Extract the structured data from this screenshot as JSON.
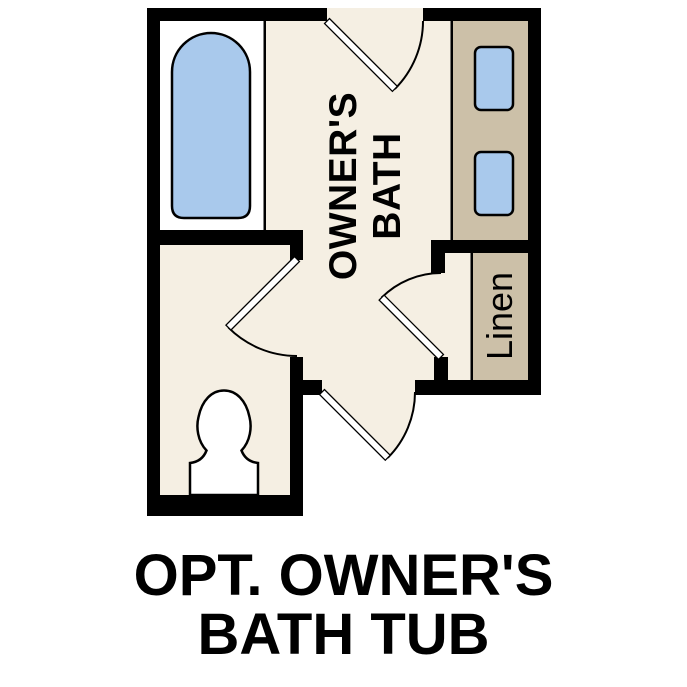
{
  "plan": {
    "room_label": {
      "line1": "OWNER'S",
      "line2": "BATH"
    },
    "closet_label": "Linen"
  },
  "caption": {
    "line1": "OPT. OWNER'S",
    "line2": "BATH TUB"
  },
  "colors": {
    "background": "#FFFFFF",
    "wall": "#000000",
    "floor": "#F5EFE3",
    "counter": "#CCC0A8",
    "fixture_blue": "#A9C9EC",
    "fixture_white": "#FFFFFF",
    "text": "#000000"
  }
}
